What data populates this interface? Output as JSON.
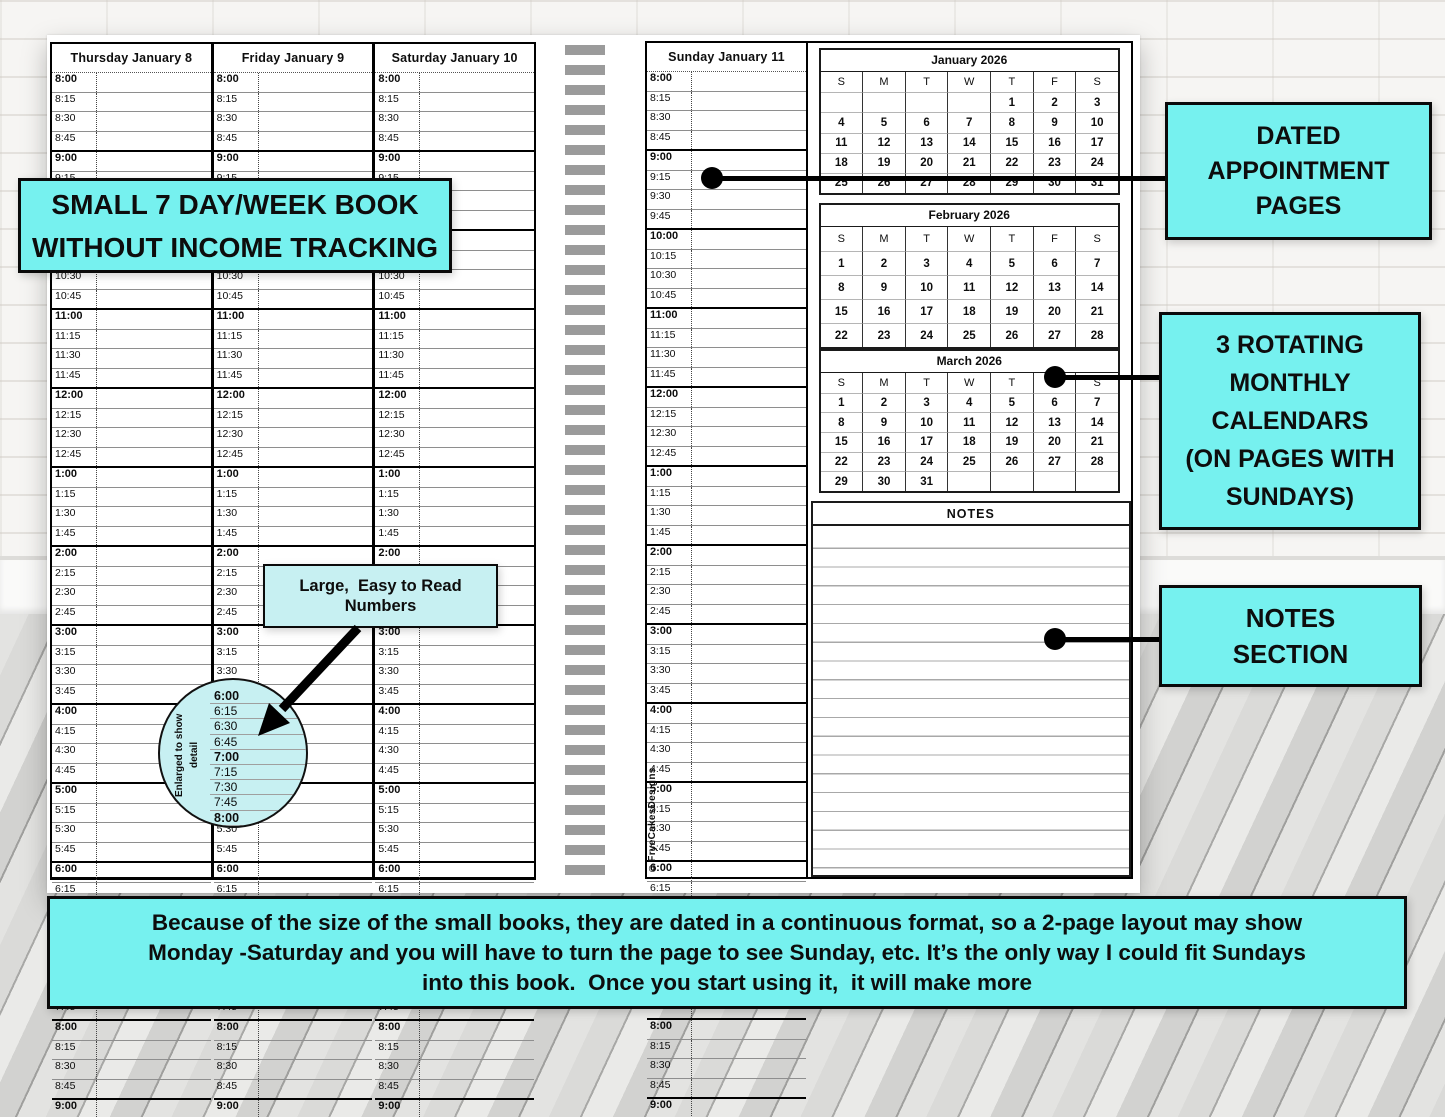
{
  "book": {
    "days": [
      {
        "label": "Thursday January 8"
      },
      {
        "label": "Friday January 9"
      },
      {
        "label": "Saturday January 10"
      },
      {
        "label": "Sunday January 11"
      }
    ],
    "time_slots": [
      "8:00",
      "8:15",
      "8:30",
      "8:45",
      "9:00",
      "9:15",
      "9:30",
      "9:45",
      "10:00",
      "10:15",
      "10:30",
      "10:45",
      "11:00",
      "11:15",
      "11:30",
      "11:45",
      "12:00",
      "12:15",
      "12:30",
      "12:45",
      "1:00",
      "1:15",
      "1:30",
      "1:45",
      "2:00",
      "2:15",
      "2:30",
      "2:45",
      "3:00",
      "3:15",
      "3:30",
      "3:45",
      "4:00",
      "4:15",
      "4:30",
      "4:45",
      "5:00",
      "5:15",
      "5:30",
      "5:45",
      "6:00",
      "6:15",
      "6:30",
      "6:45",
      "7:00",
      "7:15",
      "7:30",
      "7:45",
      "8:00",
      "8:15",
      "8:30",
      "8:45",
      "9:00"
    ],
    "calendars": [
      {
        "title": "January 2026",
        "dow": [
          "S",
          "M",
          "T",
          "W",
          "T",
          "F",
          "S"
        ],
        "weeks": [
          [
            "",
            "",
            "",
            "",
            "1",
            "2",
            "3"
          ],
          [
            "4",
            "5",
            "6",
            "7",
            "8",
            "9",
            "10"
          ],
          [
            "11",
            "12",
            "13",
            "14",
            "15",
            "16",
            "17"
          ],
          [
            "18",
            "19",
            "20",
            "21",
            "22",
            "23",
            "24"
          ],
          [
            "25",
            "26",
            "27",
            "28",
            "29",
            "30",
            "31"
          ]
        ]
      },
      {
        "title": "February 2026",
        "dow": [
          "S",
          "M",
          "T",
          "W",
          "T",
          "F",
          "S"
        ],
        "weeks": [
          [
            "1",
            "2",
            "3",
            "4",
            "5",
            "6",
            "7"
          ],
          [
            "8",
            "9",
            "10",
            "11",
            "12",
            "13",
            "14"
          ],
          [
            "15",
            "16",
            "17",
            "18",
            "19",
            "20",
            "21"
          ],
          [
            "22",
            "23",
            "24",
            "25",
            "26",
            "27",
            "28"
          ]
        ]
      },
      {
        "title": "March 2026",
        "dow": [
          "S",
          "M",
          "T",
          "W",
          "T",
          "F",
          "S"
        ],
        "weeks": [
          [
            "1",
            "2",
            "3",
            "4",
            "5",
            "6",
            "7"
          ],
          [
            "8",
            "9",
            "10",
            "11",
            "12",
            "13",
            "14"
          ],
          [
            "15",
            "16",
            "17",
            "18",
            "19",
            "20",
            "21"
          ],
          [
            "22",
            "23",
            "24",
            "25",
            "26",
            "27",
            "28"
          ],
          [
            "29",
            "30",
            "31",
            "",
            "",
            "",
            ""
          ]
        ]
      }
    ],
    "notes_label": "NOTES",
    "copyright": "©FryeCakesDesigns"
  },
  "magnifier": {
    "caption": "Enlarged to show detail",
    "times": [
      "6:00",
      "6:15",
      "6:30",
      "6:45",
      "7:00",
      "7:15",
      "7:30",
      "7:45",
      "8:00"
    ]
  },
  "callouts": {
    "small_book": {
      "lines": [
        "SMALL 7 DAY/WEEK BOOK",
        "WITHOUT INCOME TRACKING"
      ]
    },
    "easy_numbers": {
      "lines": [
        "Large,  Easy to Read",
        "Numbers"
      ]
    },
    "dated": {
      "lines": [
        "DATED",
        "APPOINTMENT",
        "PAGES"
      ]
    },
    "rotating": {
      "lines": [
        "3 ROTATING",
        "MONTHLY",
        "CALENDARS",
        "(ON PAGES WITH",
        "SUNDAYS)"
      ]
    },
    "notes": {
      "lines": [
        "NOTES",
        "SECTION"
      ]
    }
  },
  "banner": {
    "lines": [
      "Because of the size of the small books, they are dated in a continuous format, so a 2-page layout may show",
      "Monday -Saturday and you will have to turn the page to see Sunday, etc. It’s the only way I could fit Sundays",
      "into this book.  Once you start using it,  it will make more"
    ]
  },
  "colors": {
    "cyan": "#76f1ef",
    "light_cyan": "#c7f0f2",
    "binding_gray": "#9b9b9b"
  }
}
